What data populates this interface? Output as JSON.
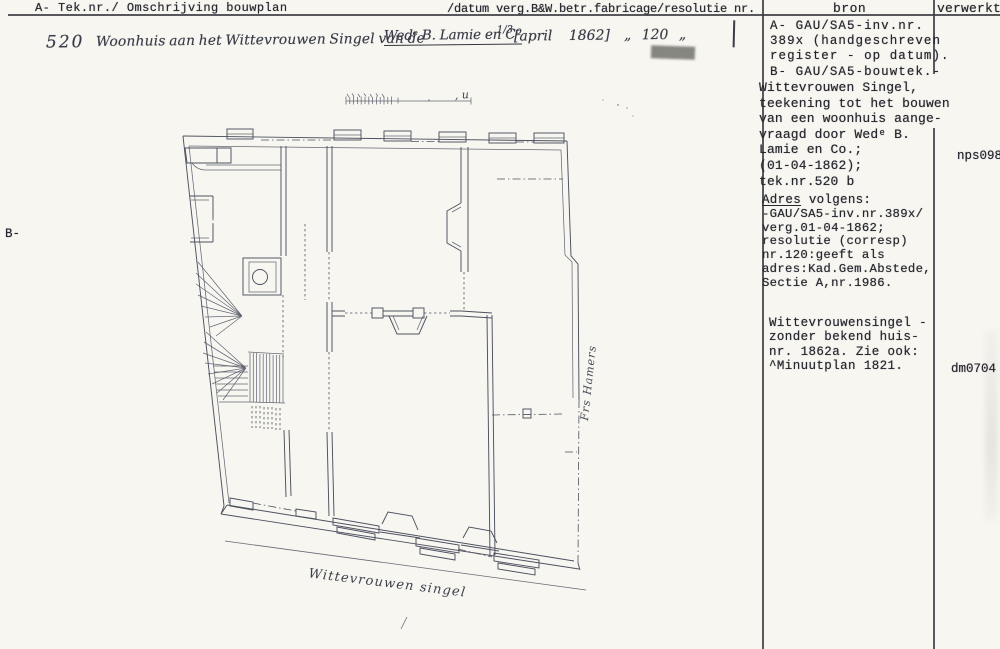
{
  "header": {
    "left": "A- Tek.nr./ Omschrijving bouwplan",
    "right": "/datum verg.B&W.betr.fabricage/resolutie nr.",
    "col_bron": "bron",
    "col_verwerkt": "verwerkt"
  },
  "margin": {
    "b_marker": "B-"
  },
  "handwritten_entry": {
    "number": "520",
    "description": "Woonhuis aan het Wittevrouwen Singel van de",
    "underlined": "Wedᵉ B. Lamie en Cº",
    "fraction": "1/3",
    "date": "[april 1862]",
    "resolution_nr": "„ 120 „"
  },
  "bron": {
    "block1": [
      "A- GAU/SA5-inv.nr.",
      "389x (handgeschreven",
      "register - op datum).",
      "B- GAU/SA5-bouwtek.-"
    ],
    "block1b": [
      "Wittevrouwen Singel,",
      "teekening tot het bouwen",
      "van een woonhuis aange-",
      "vraagd door Wedᵉ B.",
      "Lamie en Co.;",
      "(01-04-1862);",
      "tek.nr.520 b"
    ],
    "block2_title_underlined": "Adres",
    "block2_title_rest": " volgens:",
    "block2": [
      "-GAU/SA5-inv.nr.389x/",
      "verg.01-04-1862;",
      "resolutie (corresp)",
      "nr.120:geeft als",
      "adres:Kad.Gem.Abstede,",
      "Sectie A,nr.1986."
    ],
    "block3": [
      "Wittevrouwensingel -",
      "zonder bekend huis-",
      "nr. 1862a. Zie ook:",
      "^Minuutplan 1821."
    ]
  },
  "verwerkt": {
    "value1": "nps098a",
    "value2": "dm0704"
  },
  "plan": {
    "scale_label": ", u",
    "street_label": "Wittevrouwen singel",
    "side_label": "Frs Hamers"
  }
}
